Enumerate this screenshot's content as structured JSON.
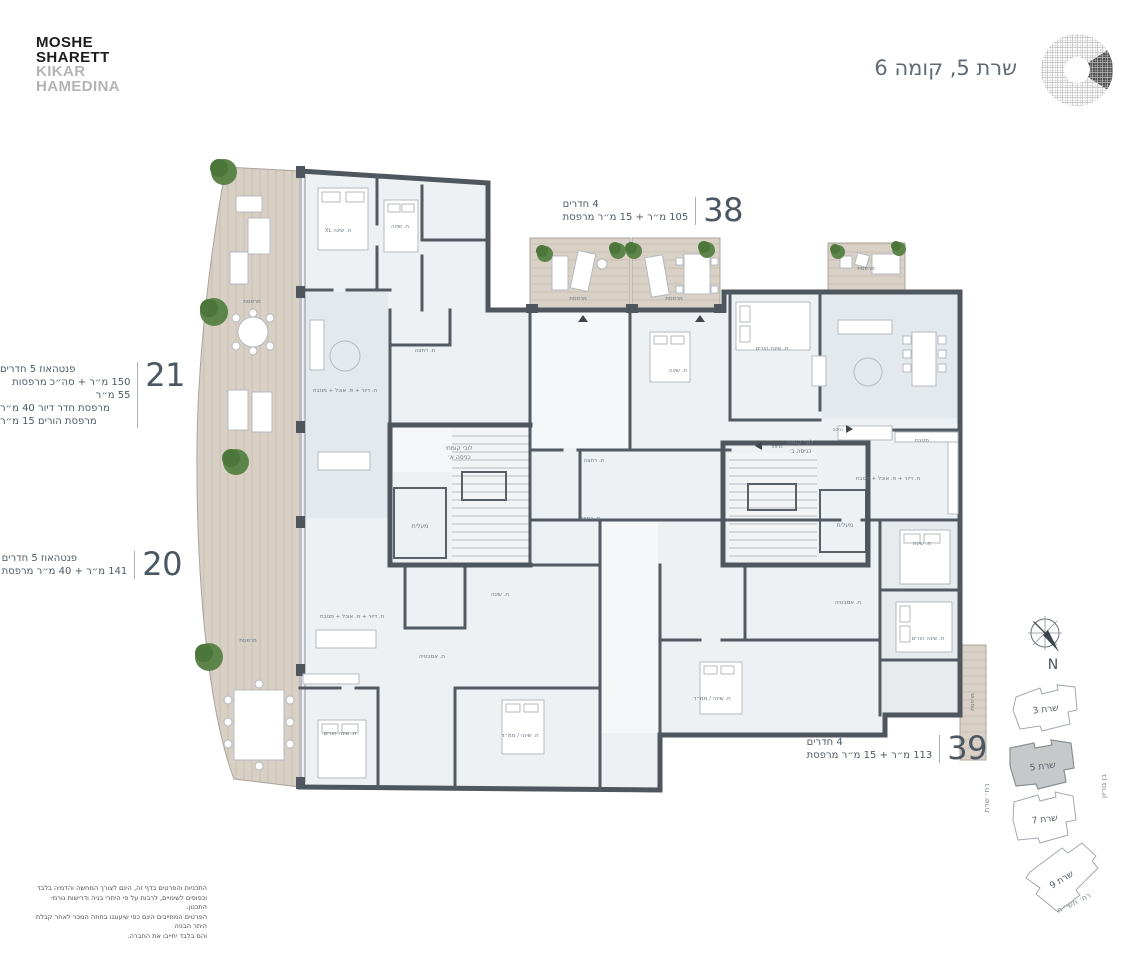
{
  "brand": {
    "line1": "MOSHE",
    "line2": "SHARETT",
    "line3": "KIKAR",
    "line4": "HAMEDINA"
  },
  "header": {
    "title": "שרת 5, קומה 6"
  },
  "apartments": [
    {
      "id": "38",
      "lines": [
        "4 חדרים",
        "105 מ״ר + 15 מ״ר מרפסת"
      ]
    },
    {
      "id": "21",
      "lines": [
        "פנטהאוז 5 חדרים",
        "150 מ״ר + סה״כ מרפסות 55 מ״ר",
        "מרפסת חדר דיור 40 מ״ר",
        "מרפסת הורים 15 מ״ר"
      ]
    },
    {
      "id": "20",
      "lines": [
        "פנטהאוז 5 חדרים",
        "141 מ״ר + 40 מ״ר מרפסת"
      ]
    },
    {
      "id": "39",
      "lines": [
        "4 חדרים",
        "113 מ״ר + 15 מ״ר מרפסת"
      ]
    }
  ],
  "plan": {
    "labels": [
      {
        "text": "ח. שינה XL",
        "x": 338,
        "y": 232
      },
      {
        "text": "ח. שינה",
        "x": 400,
        "y": 228
      },
      {
        "text": "מרפסת",
        "x": 252,
        "y": 303
      },
      {
        "text": "מרפסת",
        "x": 248,
        "y": 642
      },
      {
        "text": "ח. דיור + פ. אוכל + מטבח",
        "x": 345,
        "y": 392
      },
      {
        "text": "ח. רחצה",
        "x": 425,
        "y": 352
      },
      {
        "text": "לובי קומתי",
        "x": 459,
        "y": 450,
        "size": 6
      },
      {
        "text": "כניסה א׳",
        "x": 459,
        "y": 459,
        "size": 6
      },
      {
        "text": "מעלית",
        "x": 420,
        "y": 528,
        "size": 6
      },
      {
        "text": "מרפסת",
        "x": 578,
        "y": 300
      },
      {
        "text": "מרפסת",
        "x": 674,
        "y": 300
      },
      {
        "text": "מרפסת",
        "x": 866,
        "y": 270
      },
      {
        "text": "ח. שינה הורים",
        "x": 772,
        "y": 350
      },
      {
        "text": "ח. שינה",
        "x": 678,
        "y": 372
      },
      {
        "text": "ח. רחצה",
        "x": 594,
        "y": 462
      },
      {
        "text": "ח. רחצה",
        "x": 590,
        "y": 520
      },
      {
        "text": "לובי קומתי",
        "x": 800,
        "y": 444,
        "size": 6
      },
      {
        "text": "כניסה ב׳",
        "x": 800,
        "y": 453,
        "size": 6
      },
      {
        "text": "מעלית",
        "x": 845,
        "y": 527,
        "size": 6
      },
      {
        "text": "ח. דיור + פ. אוכל + מטבח",
        "x": 888,
        "y": 480
      },
      {
        "text": "מטבח",
        "x": 922,
        "y": 442
      },
      {
        "text": "ח. דיור + פ. אוכל + מטבח",
        "x": 352,
        "y": 618
      },
      {
        "text": "ח. שינה",
        "x": 500,
        "y": 596
      },
      {
        "text": "ח. אמבטיה",
        "x": 432,
        "y": 658
      },
      {
        "text": "ח. שינה הורים",
        "x": 340,
        "y": 735
      },
      {
        "text": "ח. שינה / ממ״ד",
        "x": 520,
        "y": 737
      },
      {
        "text": "ח. שינה",
        "x": 922,
        "y": 545
      },
      {
        "text": "ח. אמבטיה",
        "x": 848,
        "y": 604
      },
      {
        "text": "ח. שינה הורים",
        "x": 928,
        "y": 640
      },
      {
        "text": "ח. שינה / ממ״ד",
        "x": 712,
        "y": 700
      },
      {
        "text": "כניסה",
        "x": 777,
        "y": 448,
        "size": 4.5
      },
      {
        "text": "כניסה",
        "x": 838,
        "y": 431,
        "size": 4.5
      },
      {
        "text": "מרפסת",
        "x": 974,
        "y": 702,
        "r": -90
      }
    ]
  },
  "compass": {
    "north": "N"
  },
  "site_plan": {
    "buildings": [
      {
        "label": "שרת 3",
        "highlighted": false
      },
      {
        "label": "שרת 5",
        "highlighted": true
      },
      {
        "label": "שרת 7",
        "highlighted": false
      },
      {
        "label": "שרת 9",
        "highlighted": false
      }
    ],
    "streets": {
      "left": "רח׳ שרת",
      "right": "בן גוריון",
      "bottom": "רח׳ תשי״ח"
    }
  },
  "disclaimer": {
    "lines": [
      "התכניות והפרטים בדף זה, הינם לצורך המחשה והדמיה בלבד",
      "וכפופים לשינויים, לרבות על פי היתרי בניה ודרישות גורמי התכנון.",
      "הפרטים המחייבים הינם כפי שיעוגנו בחוזה המכר לאחר קבלת היתר הבניה",
      "והם בלבד יחייבו את החברה."
    ]
  },
  "colors": {
    "wall": "#50565e",
    "room": "#eef1f3",
    "deck": "#d8d0c5",
    "accent": "#4b5763",
    "tree": "#53793e"
  }
}
